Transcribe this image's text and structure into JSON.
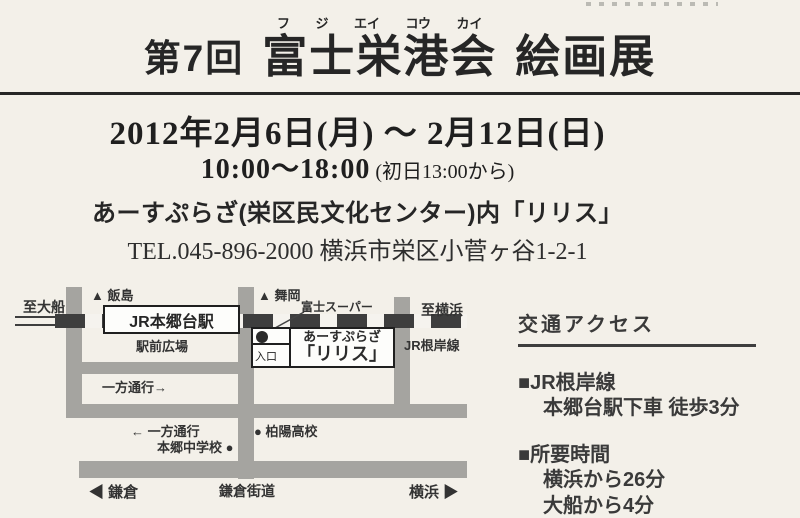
{
  "colors": {
    "background": "#f3f0e9",
    "road_gray": "#a5a4a0",
    "rail_dark": "#3e3e3e",
    "text_dark": "#262626"
  },
  "title": {
    "prefix": "第7回",
    "main": "富士栄港会",
    "furigana": [
      "フ",
      "ジ",
      "エイ",
      "コウ",
      "カイ"
    ],
    "suffix": "絵画展"
  },
  "schedule": {
    "date_line": "2012年2月6日(月) ～ 2月12日(日)",
    "time_main": "10:00～18:00",
    "time_note": " (初日13:00から)"
  },
  "venue": {
    "name_line": "あーすぷらざ(栄区民文化センター)内「リリス」",
    "tel_line": "TEL.045-896-2000 横浜市栄区小菅ヶ谷1-2-1"
  },
  "map": {
    "labels": {
      "to_ofuna": "至大船",
      "iijima": "▲ 飯島",
      "maioka": "▲ 舞岡",
      "fuji_super": "富士スーパー",
      "to_yokohama": "至横浜",
      "station": "JR本郷台駅",
      "ekimae_hiroba": "駅前広場",
      "jr_negishi_line": "JR根岸線",
      "earth_plaza": "あーすぷらざ",
      "lilith": "「リリス」",
      "entrance": "入口",
      "one_way_right": "一方通行→",
      "one_way_left": "← 一方通行",
      "hakuyo_hs": "● 柏陽高校",
      "hongo_jhs": "本郷中学校 ●",
      "kamakura": "◀ 鎌倉",
      "kamakura_kaido": "鎌倉街道",
      "yokohama": "横浜 ▶"
    }
  },
  "access": {
    "heading": "交通アクセス",
    "items": [
      {
        "title": "■JR根岸線",
        "lines": [
          "本郷台駅下車 徒歩3分"
        ]
      },
      {
        "title": "■所要時間",
        "lines": [
          "横浜から26分",
          "大船から4分"
        ]
      }
    ]
  }
}
